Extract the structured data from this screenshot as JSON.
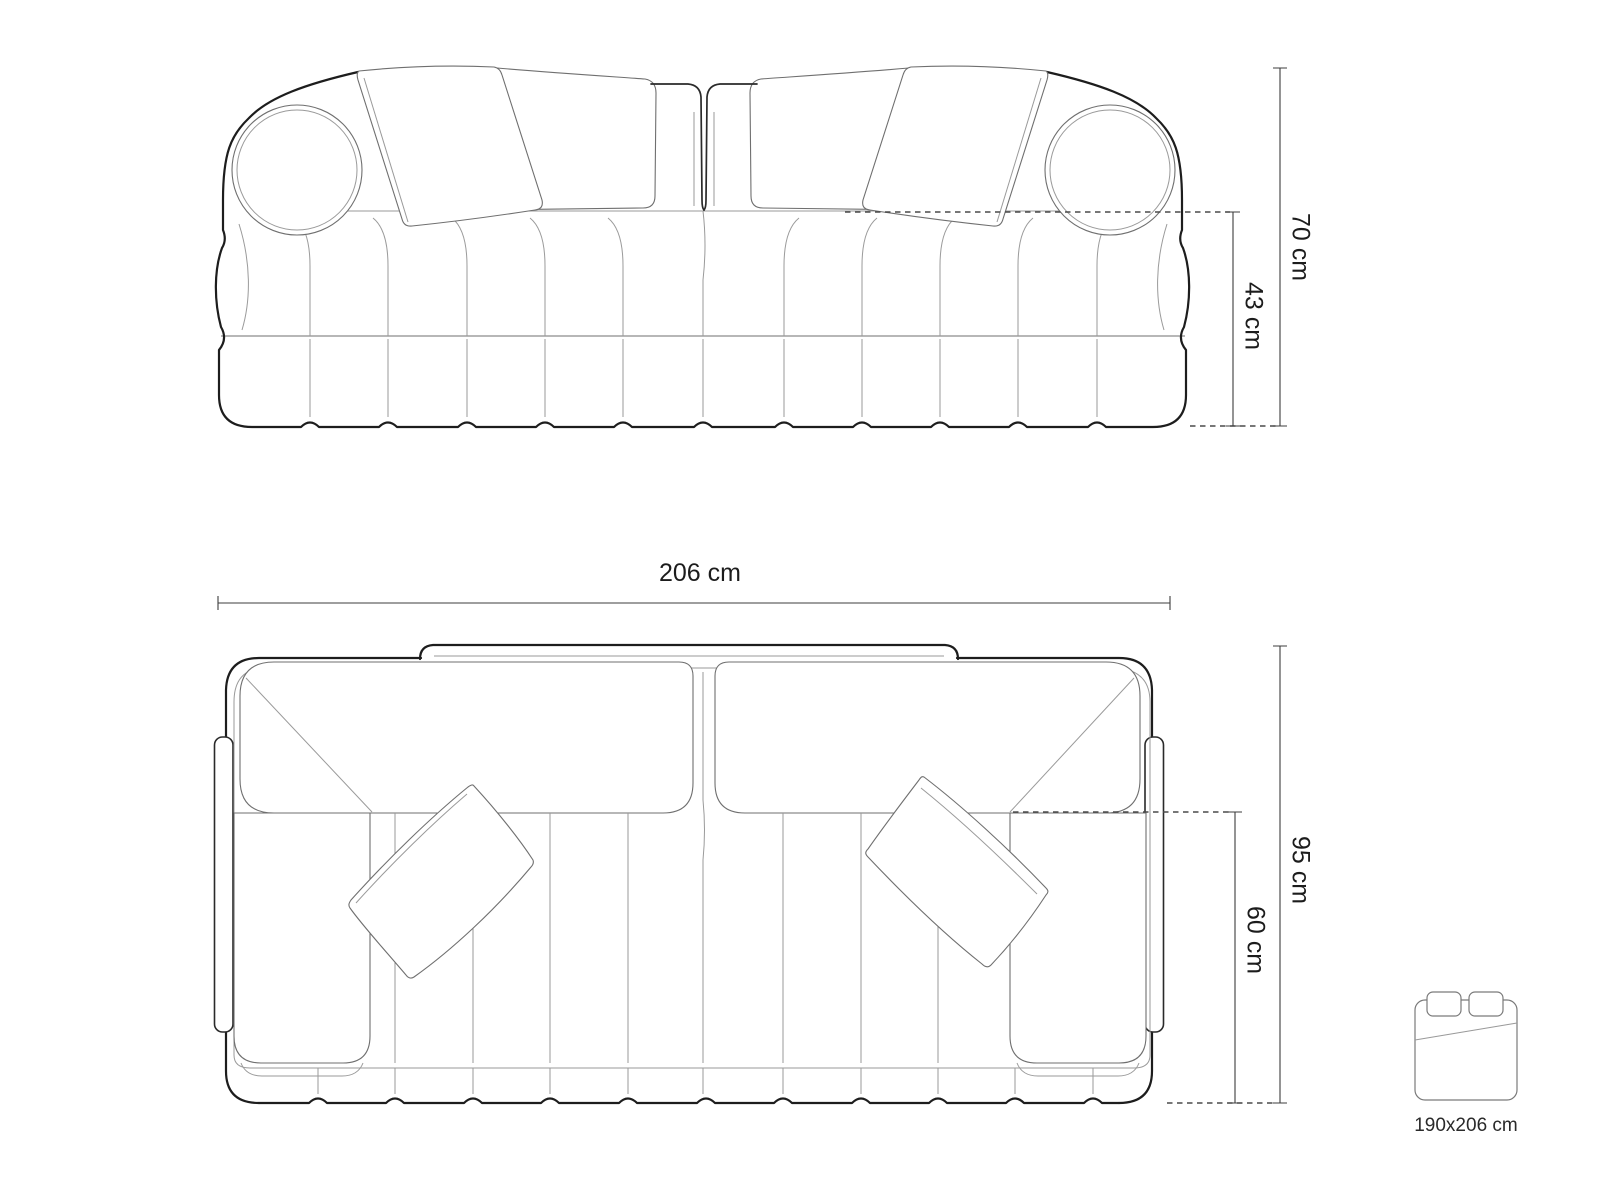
{
  "diagram": {
    "front_view": {
      "overall_height": "70 cm",
      "seat_height": "43 cm"
    },
    "top_view": {
      "overall_width": "206 cm",
      "overall_depth": "95 cm",
      "seat_depth": "60 cm"
    },
    "sleeping_area": {
      "size": "190x206 cm"
    }
  },
  "colors": {
    "outline": "#1d1d1d",
    "detail": "#9a9a9a",
    "medium": "#6f6f6f",
    "dimension": "#3c3c3c",
    "background": "#ffffff"
  }
}
